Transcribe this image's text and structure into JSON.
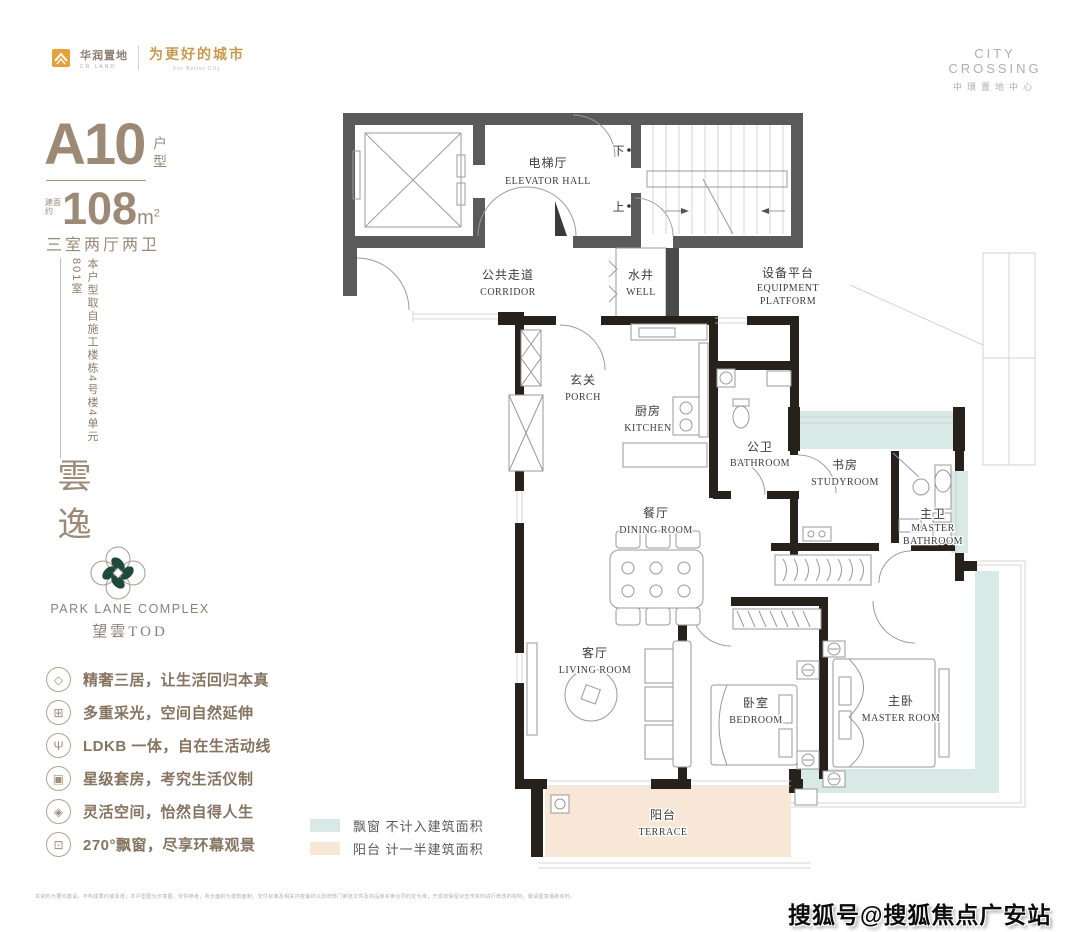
{
  "header": {
    "brand_left": {
      "name_zh": "华润置地",
      "name_en": "CR LAND",
      "slogan_zh": "为更好的城市",
      "slogan_en": "For Better City"
    },
    "brand_right": {
      "name_en": "CITY CROSSING",
      "name_zh": "中環置地中心"
    }
  },
  "unit_panel": {
    "unit_code": "A10",
    "unit_suffix": "户型",
    "area_prefix": "建面约",
    "area_value": "108",
    "area_unit": "m",
    "area_exp": "2",
    "rooms_summary": "三室两厅两卫",
    "source_note": "本户型取自施工楼栋4号楼4单元801室",
    "script_name": "雲逸",
    "brand_logo": {
      "icon": "quatrefoil-flower-logo",
      "title": "PARK LANE COMPLEX",
      "subtitle": "望雲TOD"
    },
    "features": [
      {
        "icon": "diamond-icon",
        "glyph": "◇",
        "text": "精奢三居，让生活回归本真"
      },
      {
        "icon": "daylight-window-icon",
        "glyph": "⊞",
        "text": "多重采光，空间自然延伸"
      },
      {
        "icon": "dining-set-icon",
        "glyph": "Ψ",
        "text": "LDKB 一体，自在生活动线"
      },
      {
        "icon": "suite-bed-icon",
        "glyph": "▣",
        "text": "星级套房，考究生活仪制"
      },
      {
        "icon": "flexible-space-icon",
        "glyph": "◈",
        "text": "灵活空间，怡然自得人生"
      },
      {
        "icon": "bay-window-icon",
        "glyph": "⊡",
        "text": "270°飘窗，尽享环幕观景"
      }
    ]
  },
  "legend": {
    "items": [
      {
        "swatch_color": "#d9e9e5",
        "label": "飘窗 不计入建筑面积"
      },
      {
        "swatch_color": "#f8e7d7",
        "label": "阳台 计一半建筑面积"
      }
    ]
  },
  "floor_plan": {
    "colors": {
      "bay_window_fill": "#d9e9e5",
      "terrace_fill": "#f8e7d7",
      "common_wall": "#5a5a5a",
      "unit_wall": "#27211b"
    },
    "stairs": {
      "down": "下",
      "up": "上"
    },
    "rooms": {
      "elevator_hall": {
        "zh": "电梯厅",
        "en": "ELEVATOR HALL"
      },
      "corridor": {
        "zh": "公共走道",
        "en": "CORRIDOR"
      },
      "well": {
        "zh": "水井",
        "en": "WELL"
      },
      "equipment_platform": {
        "zh": "设备平台",
        "en1": "EQUIPMENT",
        "en2": "PLATFORM"
      },
      "porch": {
        "zh": "玄关",
        "en": "PORCH"
      },
      "kitchen": {
        "zh": "厨房",
        "en": "KITCHEN"
      },
      "bathroom": {
        "zh": "公卫",
        "en": "BATHROOM"
      },
      "studyroom": {
        "zh": "书房",
        "en": "STUDYROOM"
      },
      "master_bathroom": {
        "zh": "主卫",
        "en1": "MASTER",
        "en2": "BATHROOM"
      },
      "dining_room": {
        "zh": "餐厅",
        "en": "DINING ROOM"
      },
      "living_room": {
        "zh": "客厅",
        "en": "LIVING ROOM"
      },
      "bedroom": {
        "zh": "卧室",
        "en": "BEDROOM"
      },
      "master_room": {
        "zh": "主卧",
        "en": "MASTER ROOM"
      },
      "terrace": {
        "zh": "阳台",
        "en": "TERRACE"
      }
    }
  },
  "footer": {
    "disclaimer": "本资料为要约邀请，不构成要约或承诺；本户型图为示意图，仅供参考，所示面积为建筑面积，交付标准及相关内容最终以政府部门审批文件及商品房买卖合同约定为准；开发商保留对宣传资料进行修改的权利，敬请留意最新资料。",
    "watermark": "搜狐号@搜狐焦点广安站"
  }
}
